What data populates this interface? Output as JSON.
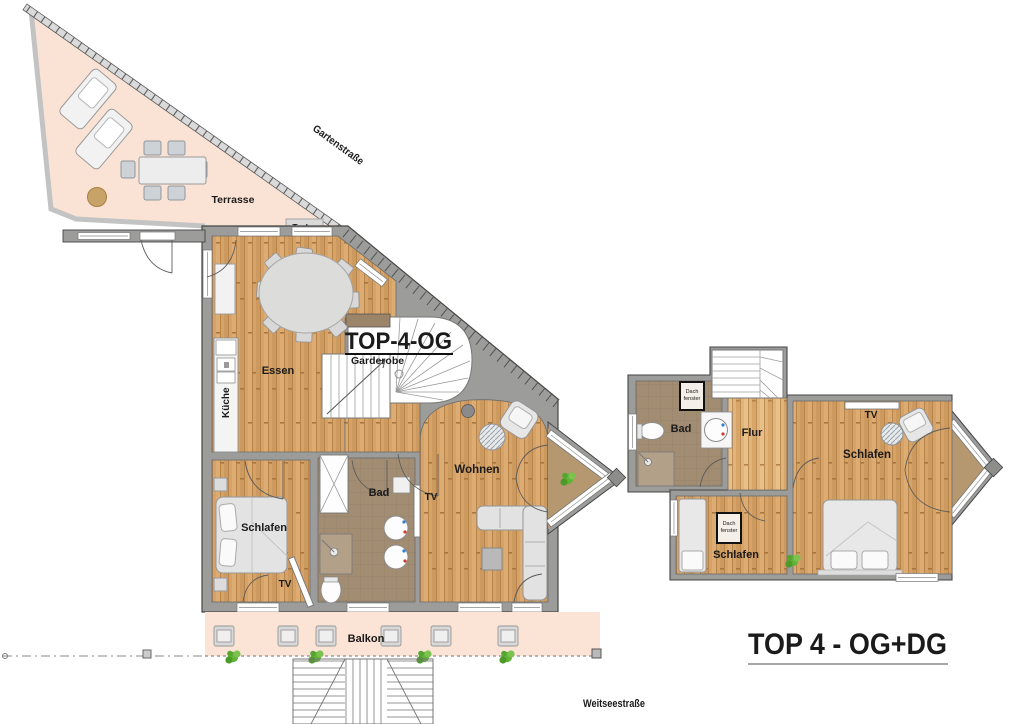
{
  "titles": {
    "og": "TOP-4-OG",
    "combined": "TOP 4 - OG+DG"
  },
  "streets": {
    "garten": "Gartenstraße",
    "weitsee": "Weitseestraße"
  },
  "outdoor": {
    "terrasse": "Terrasse",
    "balkon": "Balkon",
    "truhe": "Truhe"
  },
  "rooms": {
    "essen": "Essen",
    "kueche": "Küche",
    "garderobe": "Garderobe",
    "schlafen": "Schlafen",
    "bad": "Bad",
    "wohnen": "Wohnen",
    "flur": "Flur",
    "tv": "TV",
    "dachfenster_line1": "Dach",
    "dachfenster_line2": "fenster"
  },
  "colors": {
    "terrace": "#fae3d4",
    "balcony": "#fbe4d5",
    "wood": "#d5a267",
    "wood_light": "#e0b47c",
    "bathroom_floor": "#a28d72",
    "bay_floor": "#b5986f",
    "wall": "#9c9c9a",
    "plant": "#5fae36",
    "furniture": "#e4e4e4",
    "title_text": "#111111"
  }
}
